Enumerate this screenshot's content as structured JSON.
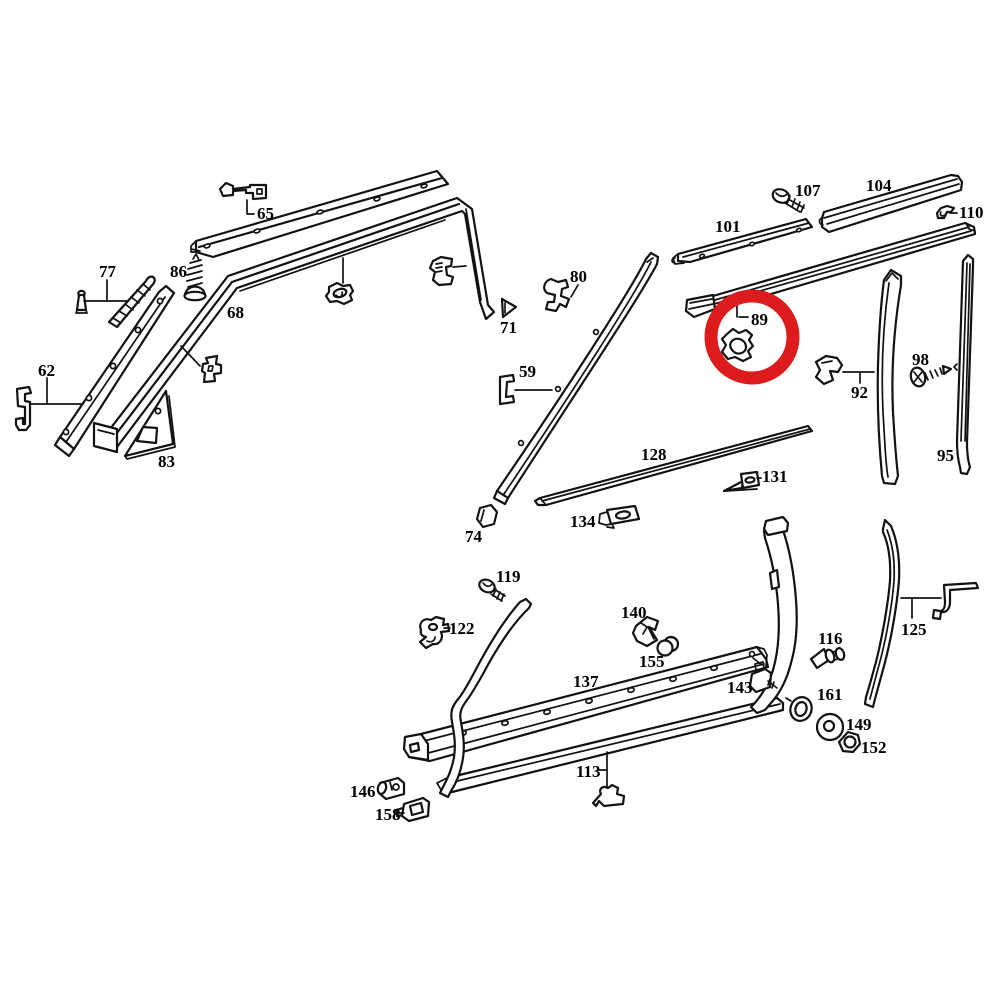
{
  "diagram": {
    "type": "exploded-parts-diagram",
    "background_color": "#ffffff",
    "line_color": "#121212",
    "highlight": {
      "part": "89",
      "color": "#dc1c1c",
      "cx": 752,
      "cy": 337,
      "r": 41,
      "stroke_width": 13
    },
    "parts": [
      {
        "part": "65",
        "x": 257,
        "y": 219
      },
      {
        "part": "77",
        "x": 99,
        "y": 277
      },
      {
        "part": "86",
        "x": 170,
        "y": 277
      },
      {
        "part": "68",
        "x": 227,
        "y": 318
      },
      {
        "part": "62",
        "x": 38,
        "y": 376
      },
      {
        "part": "83",
        "x": 158,
        "y": 467
      },
      {
        "part": "71",
        "x": 500,
        "y": 333
      },
      {
        "part": "80",
        "x": 570,
        "y": 282
      },
      {
        "part": "59",
        "x": 519,
        "y": 377
      },
      {
        "part": "74",
        "x": 465,
        "y": 542
      },
      {
        "part": "128",
        "x": 641,
        "y": 460
      },
      {
        "part": "134",
        "x": 570,
        "y": 527
      },
      {
        "part": "131",
        "x": 762,
        "y": 482
      },
      {
        "part": "101",
        "x": 715,
        "y": 232
      },
      {
        "part": "107",
        "x": 795,
        "y": 196
      },
      {
        "part": "104",
        "x": 866,
        "y": 191
      },
      {
        "part": "110",
        "x": 959,
        "y": 218
      },
      {
        "part": "89",
        "x": 751,
        "y": 325
      },
      {
        "part": "92",
        "x": 851,
        "y": 398
      },
      {
        "part": "98",
        "x": 912,
        "y": 365
      },
      {
        "part": "95",
        "x": 937,
        "y": 461
      },
      {
        "part": "119",
        "x": 496,
        "y": 582
      },
      {
        "part": "122",
        "x": 449,
        "y": 634
      },
      {
        "part": "140",
        "x": 621,
        "y": 618
      },
      {
        "part": "155",
        "x": 639,
        "y": 667
      },
      {
        "part": "137",
        "x": 573,
        "y": 687
      },
      {
        "part": "143",
        "x": 727,
        "y": 693
      },
      {
        "part": "113",
        "x": 576,
        "y": 777
      },
      {
        "part": "146",
        "x": 350,
        "y": 797
      },
      {
        "part": "158",
        "x": 375,
        "y": 820
      },
      {
        "part": "116",
        "x": 818,
        "y": 644
      },
      {
        "part": "161",
        "x": 817,
        "y": 700
      },
      {
        "part": "149",
        "x": 846,
        "y": 730
      },
      {
        "part": "152",
        "x": 861,
        "y": 753
      },
      {
        "part": "125",
        "x": 901,
        "y": 635
      }
    ]
  }
}
